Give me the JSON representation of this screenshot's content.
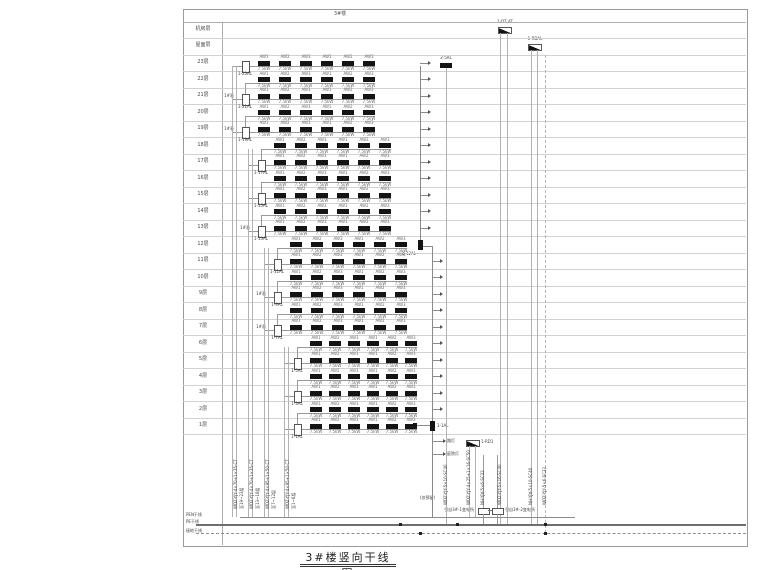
{
  "header": {
    "building": "3#楼"
  },
  "title": "3#楼竖向干线图",
  "floors": [
    {
      "label": "机房层",
      "type": "machine"
    },
    {
      "label": "屋面层",
      "type": "roof"
    },
    {
      "label": "23层",
      "n": 23,
      "meter": "1-23AL"
    },
    {
      "label": "22层",
      "n": 22
    },
    {
      "label": "21层",
      "n": 21,
      "meter": "1-21AL",
      "tag": "1#表"
    },
    {
      "label": "20层",
      "n": 20
    },
    {
      "label": "19层",
      "n": 19,
      "meter": "1-19AL",
      "tag": "1#表"
    },
    {
      "label": "18层",
      "n": 18
    },
    {
      "label": "17层",
      "n": 17,
      "meter": "1-17AL"
    },
    {
      "label": "16层",
      "n": 16
    },
    {
      "label": "15层",
      "n": 15,
      "meter": "1-15AL"
    },
    {
      "label": "14层",
      "n": 14
    },
    {
      "label": "13层",
      "n": 13,
      "meter": "1-13AL",
      "tag": "1#表"
    },
    {
      "label": "12层",
      "n": 12
    },
    {
      "label": "11层",
      "n": 11,
      "meter": "1-11AL"
    },
    {
      "label": "10层",
      "n": 10
    },
    {
      "label": "9层",
      "n": 9,
      "meter": "1-9AL",
      "tag": "1#表"
    },
    {
      "label": "8层",
      "n": 8
    },
    {
      "label": "7层",
      "n": 7,
      "meter": "1-7AL",
      "tag": "1#表"
    },
    {
      "label": "6层",
      "n": 6
    },
    {
      "label": "5层",
      "n": 5,
      "meter": "1-5AL"
    },
    {
      "label": "4层",
      "n": 4
    },
    {
      "label": "3层",
      "n": 3,
      "meter": "1-3AL"
    },
    {
      "label": "2层",
      "n": 2
    },
    {
      "label": "1层",
      "n": 1,
      "meter": "1-1AL"
    }
  ],
  "unit_boxes": {
    "top_labels": [
      "AW1",
      "AW2",
      "AW3",
      "AW1",
      "AW2",
      "AW3"
    ],
    "power": "7.5kW"
  },
  "right": {
    "machine_room_box": "1-DT,AT",
    "roof_box": "1-RDAL",
    "f23_box": "2-5AL",
    "f12_box": "1-12AL",
    "f1_box": "1-1AL",
    "rd_box": "1-RD1",
    "street_light": "路灯",
    "garden_light": "庭院灯",
    "reserved": "(仅预留)"
  },
  "bottom": {
    "risers": [
      {
        "spec": "WDZ-YJY-4×70+1×35-CT",
        "dest": "至19~23层"
      },
      {
        "spec": "WDZ-YJY-4×70+1×35-CT",
        "dest": "至13~18层"
      },
      {
        "spec": "WDZ-YJY-4×95+1×50-CT",
        "dest": "至7~12层"
      },
      {
        "spec": "WDZ-YJY-4×95+1×50-CT",
        "dest": "至1~6层"
      }
    ],
    "right_specs": [
      "WDZ-YJY-5×10-SC40",
      "WDZ-YJY-4×25+1×16-SC50",
      "NH-YJV-5×6-SC32",
      "WDZ-YJY-5×16-SC40",
      "NH-YJV-5×10-SC40",
      "WDZ-YJY-5×6-SC32"
    ],
    "sources": {
      "left": "引自3#-1变电所",
      "right": "引自3#-2变电所"
    },
    "bus_labels": [
      "PEN干线",
      "PE干线",
      "接地干线"
    ]
  }
}
